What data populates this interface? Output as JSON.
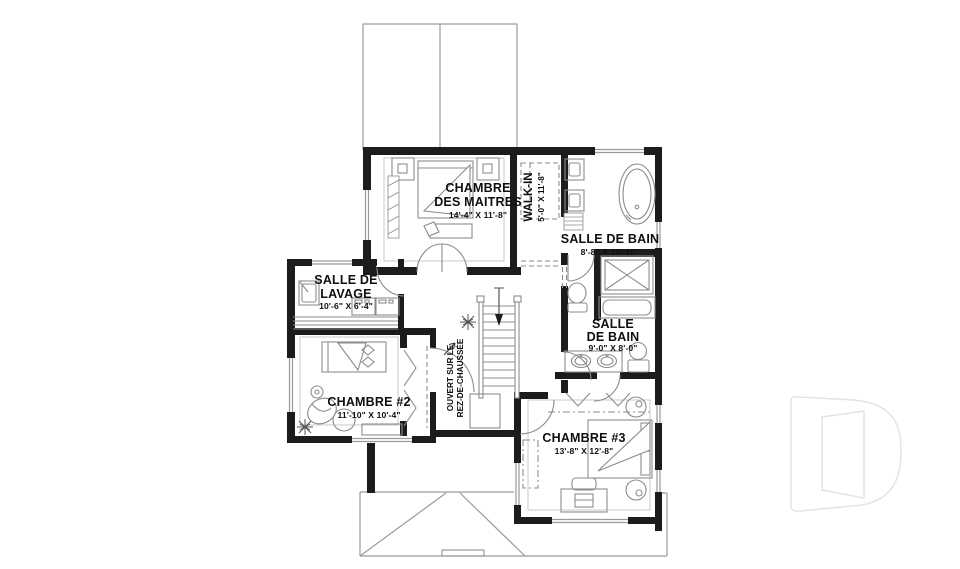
{
  "drawing": {
    "kind": "second-floor residential plan",
    "language": "French"
  },
  "colors": {
    "wall": "#1c1c1c",
    "fixture_line": "#8c8c8c",
    "roof_line": "#9a9a9a",
    "label_text": "#0f0f0f",
    "watermark": "#e3e3e3",
    "background": "#ffffff"
  },
  "rooms": {
    "master": {
      "label_line1": "CHAMBRE",
      "label_line2": "DES MAITRES",
      "dims": "14'-4\" X 11'-8\""
    },
    "walk_in": {
      "label": "WALK-IN",
      "dims": "5'-0\" X 11'-8\""
    },
    "bath_main": {
      "label": "SALLE DE BAIN",
      "dims": "8'-8\" X 13'-10\""
    },
    "laundry": {
      "label_line1": "SALLE DE",
      "label_line2": "LAVAGE",
      "dims": "10'-6\" X 6'-4\""
    },
    "bath_second": {
      "label_line1": "SALLE",
      "label_line2": "DE BAIN",
      "dims": "9'-0\" X 8'-0\""
    },
    "bedroom2": {
      "label": "CHAMBRE #2",
      "dims": "11'-10\" X 10'-4\""
    },
    "bedroom3": {
      "label": "CHAMBRE #3",
      "dims": "13'-8\" X 12'-8\""
    },
    "open_to_below": {
      "label_line1": "OUVERT SUR LE",
      "label_line2": "REZ-DE-CHAUSSÉE"
    }
  },
  "icons": {
    "watermark": "letter-d-outline-logo",
    "stairs_arrow": "down-arrow",
    "plants": "potted-plant-symbol"
  }
}
